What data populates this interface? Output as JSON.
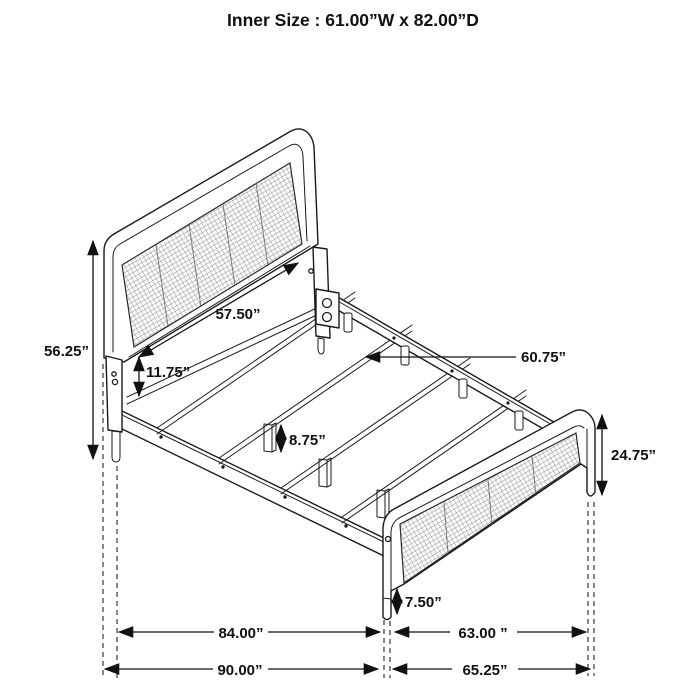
{
  "title": "Inner Size : 61.00”W x 82.00”D",
  "figure": {
    "type": "isometric-bed-frame-dimension-diagram",
    "parts": [
      "headboard with cane mesh panel",
      "footboard with cane mesh panel",
      "side rails",
      "slats with hooks",
      "center support legs"
    ],
    "annotations": {
      "headboard_width": "57.50”",
      "headboard_height": "56.25”",
      "headboard_to_rail_gap": "11.75”",
      "slat_length": "60.75”",
      "center_leg_height": "8.75”",
      "footboard_height": "24.75”",
      "footboard_clearance": "7.50”",
      "side_rail_length": "84.00”",
      "footboard_inner_width": "63.00 ”",
      "overall_length": "90.00”",
      "overall_width": "65.25”"
    }
  }
}
